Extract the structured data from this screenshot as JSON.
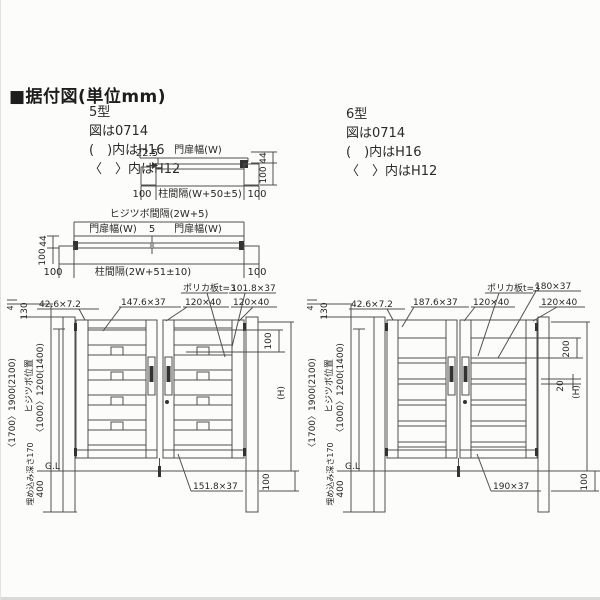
{
  "header": {
    "title": "■据付図(単位mm)"
  },
  "type5": {
    "model": "5型",
    "figure": "図は0714",
    "note_h16": "(　)内はH16",
    "note_h12": "〈　〉内はH12"
  },
  "type6": {
    "model": "6型",
    "figure": "図は0714",
    "note_h16": "(　)内はH16",
    "note_h12": "〈　〉内はH12"
  },
  "plan_single": {
    "offset": "22.5",
    "leaf_width": "門扉幅(W)",
    "depth_44": "44",
    "depth_100": "100",
    "post_left": "100",
    "span": "柱間隔(W+50±5)",
    "post_right": "100"
  },
  "plan_double": {
    "hinge_span": "ヒジツボ間隔(2W+5)",
    "leaf_width_left": "門扉幅(W)",
    "center_gap": "5",
    "leaf_width_right": "門扉幅(W)",
    "depth_44": "44",
    "depth_100": "100",
    "post_left": "100",
    "span": "柱間隔(2W+51±10)",
    "post_right": "100"
  },
  "elev5": {
    "dim_top_4": "4",
    "dim_top_130": "130",
    "post_height": "〈1700〉1900(2100)",
    "hinge_label": "ヒジツボ位置",
    "hinge_height": "〈1000〉1200(1400)",
    "embed_depth": "埋め込み深さ170",
    "embed_400": "400",
    "ground": "G.L",
    "frame_profile": "42.6×7.2",
    "slat_profile": "147.6×37",
    "stile_profile_center": "120×40",
    "poly_panel": "ポリカ板t=3",
    "slat2_profile": "101.8×37",
    "stile_profile_right": "120×40",
    "slat_pitch": "100",
    "gate_height": "(H)",
    "bottom_rail_profile": "151.8×37",
    "ground_clearance": "100"
  },
  "elev6": {
    "dim_top_4": "4",
    "dim_top_130": "130",
    "post_height": "〈1700〉1900(2100)",
    "hinge_label": "ヒジツボ位置",
    "hinge_height": "〈1000〉1200(1400)",
    "embed_depth": "埋め込み深さ170",
    "embed_400": "400",
    "ground": "G.L",
    "frame_profile": "42.6×7.2",
    "rail_profile": "187.6×37",
    "stile_profile_center": "120×40",
    "poly_panel": "ポリカ板t=3",
    "rail2_profile": "180×37",
    "stile_profile_right": "120×40",
    "panel_pitch": "200",
    "rail_height": "20",
    "gate_height": "(H)",
    "bottom_rail_profile": "190×37",
    "ground_clearance": "100"
  }
}
